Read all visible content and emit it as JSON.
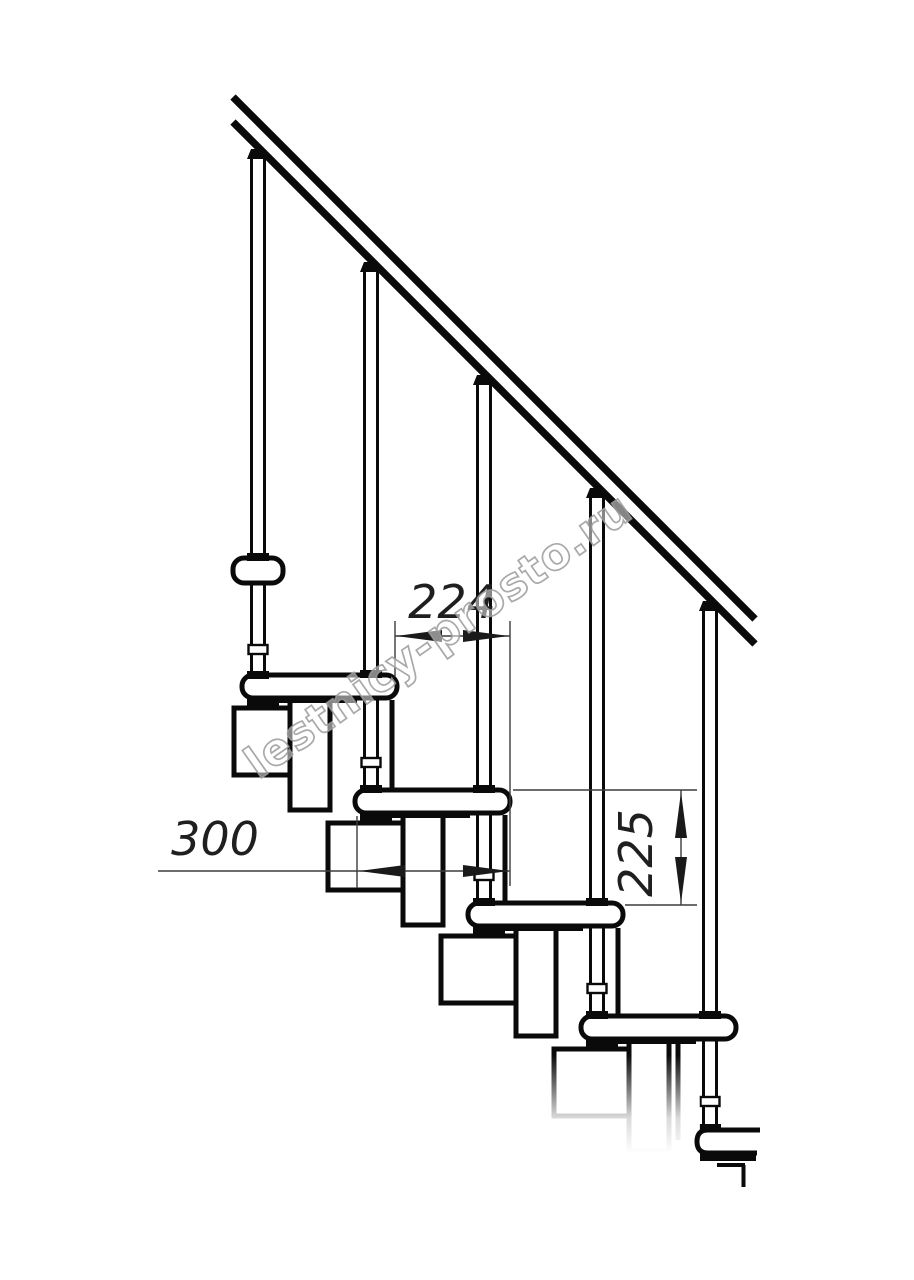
{
  "drawing": {
    "kind": "staircase-side-view-technical-drawing",
    "dimensions": {
      "run": {
        "value": "224"
      },
      "tread_length": {
        "value": "300"
      },
      "rise": {
        "value": "225"
      }
    },
    "watermark": {
      "text": "lestnicy-prosto.ru"
    },
    "colors": {
      "background": "#ffffff",
      "line": "#0a0a0a",
      "dim_line": "#3c3c3c",
      "watermark_outline": "#9a9a9a"
    }
  }
}
